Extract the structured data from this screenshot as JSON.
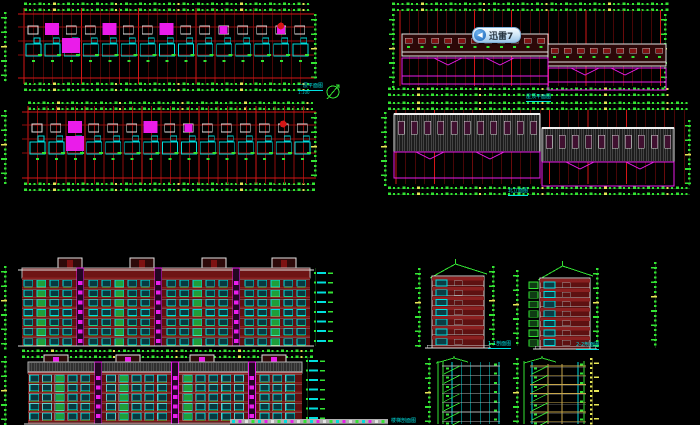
{
  "app": {
    "background": "#000000",
    "kind": "cad-architectural-sheet"
  },
  "watermark": {
    "label": "迅雷7",
    "icon": "xunlei-arrow-icon"
  },
  "labels": {
    "plan1_title": "一层平面图",
    "plan1_scale": "1:100",
    "roof_plan_title": "屋顶平面图",
    "rear_elev_title": "北立面图",
    "side_elev1_title": "1-1剖面图",
    "side_elev2_title": "2-2剖面图",
    "bottom_partial_title": "楼梯剖面图"
  },
  "palette": {
    "bg": "#000000",
    "red": "#8f0d0d",
    "red_bright": "#d41616",
    "green": "#33e433",
    "green_dim": "#1d6b1d",
    "yellow": "#e6e655",
    "cyan": "#00dede",
    "magenta": "#ea1cea",
    "white": "#e2e2e2",
    "gray": "#b2b2b2",
    "wall": "#5e1111",
    "slab": "#8a2020",
    "window_fill": "#073940",
    "window_green": "#1f9e3a",
    "hatch": "#8f8f8f",
    "band_fill": "#1c1c1c",
    "win_purple": "#401030",
    "tan": "#c8a84b",
    "badge_blue": "#2b7fd4"
  },
  "scene": {
    "plans": [
      {
        "gx": 24,
        "gy": 14,
        "gw": 286,
        "gh": 64,
        "bays": 15,
        "verts": 30,
        "step": 9.55,
        "seed": 3,
        "topDim": {
          "x": 24,
          "y": 2,
          "w": 286
        },
        "botDim": {
          "x": 24,
          "y": 82,
          "w": 286
        },
        "leftCol": {
          "x": 4,
          "y": 12,
          "h": 70
        },
        "rightCol": {
          "x": 314,
          "y": 14,
          "h": 64
        }
      },
      {
        "gx": 28,
        "gy": 112,
        "gw": 284,
        "gh": 66,
        "bays": 15,
        "verts": 30,
        "step": 9.5,
        "seed": 8,
        "topDim": {
          "x": 28,
          "y": 101,
          "w": 284
        },
        "botDim": {
          "x": 24,
          "y": 182,
          "w": 288
        },
        "leftCol": {
          "x": 4,
          "y": 110,
          "h": 72
        },
        "rightCol": {
          "x": 314,
          "y": 112,
          "h": 64
        }
      }
    ],
    "roofPlan": {
      "topDim": {
        "x": 392,
        "y": 2,
        "w": 274
      },
      "botDim": {
        "x": 388,
        "y": 87,
        "w": 280
      },
      "verts": 29,
      "vx": 400,
      "step": 9.3,
      "vy1": 10,
      "vy2": 86,
      "bands": [
        {
          "x": 402,
          "y": 34,
          "w": 146,
          "h": 22,
          "win": 11
        },
        {
          "x": 548,
          "y": 44,
          "w": 118,
          "h": 22,
          "win": 9
        }
      ],
      "mag": [
        {
          "x": 402,
          "y": 58,
          "w": 146,
          "h": 26,
          "chev": [
            448,
            500
          ]
        },
        {
          "x": 548,
          "y": 68,
          "w": 118,
          "h": 22,
          "chev": [
            585,
            625
          ]
        }
      ],
      "cols": [
        {
          "x": 392,
          "y": 14,
          "h": 72
        },
        {
          "x": 664,
          "y": 14,
          "h": 72
        }
      ]
    },
    "rearElev": {
      "topDim": {
        "x": 388,
        "y": 101,
        "w": 300
      },
      "botDim": {
        "x": 388,
        "y": 186,
        "w": 302
      },
      "verts": 31,
      "vx": 396,
      "step": 9.6,
      "vy1": 110,
      "vy2": 184,
      "bands": [
        {
          "x": 394,
          "y": 114,
          "w": 146,
          "h": 38,
          "win": 11
        },
        {
          "x": 542,
          "y": 128,
          "w": 132,
          "h": 34,
          "win": 10
        }
      ],
      "mag": [
        {
          "x": 394,
          "y": 152,
          "w": 146,
          "h": 26,
          "chev": [
            430,
            490
          ]
        },
        {
          "x": 542,
          "y": 162,
          "w": 132,
          "h": 24,
          "chev": [
            580,
            640
          ]
        }
      ],
      "cols": [
        {
          "x": 384,
          "y": 112,
          "h": 74
        },
        {
          "x": 688,
          "y": 120,
          "h": 66
        }
      ]
    },
    "frontElevs": [
      {
        "x": 22,
        "w": 288,
        "roofY": 268,
        "bodyTop": 278,
        "floors": 7,
        "floorH": 9.7,
        "bays": 22,
        "bayW": 13,
        "bx0": 24,
        "ground": 346,
        "stairs": [
          4,
          10,
          16
        ],
        "bulk": [
          58,
          130,
          202,
          272
        ],
        "bulkY": 258,
        "variant": "A",
        "leftCol": {
          "x": 4,
          "y": 266,
          "h": 82
        },
        "rightCol": {
          "x": 314,
          "y": 268,
          "h": 78
        }
      },
      {
        "x": 28,
        "w": 274,
        "roofY": 362,
        "bodyTop": 373,
        "floors": 6,
        "floorH": 9.5,
        "bays": 21,
        "bayW": 12.8,
        "bx0": 30,
        "ground": 424,
        "stairs": [
          5,
          11,
          17
        ],
        "bulk": [
          44,
          116,
          190,
          262
        ],
        "bulkY": 355,
        "variant": "B",
        "leftCol": {
          "x": 4,
          "y": 356,
          "h": 68
        },
        "rightCol": {
          "x": 306,
          "y": 356,
          "h": 68
        }
      }
    ],
    "sideElevs": [
      {
        "x": 432,
        "w": 52,
        "top": 264,
        "bodyTop": 276,
        "floors": 7,
        "floorH": 9.8,
        "ground": 348,
        "balc": false,
        "cols": [
          {
            "x": 418,
            "y": 268,
            "h": 78
          },
          {
            "x": 492,
            "y": 266,
            "h": 80
          }
        ]
      },
      {
        "x": 540,
        "w": 50,
        "top": 266,
        "bodyTop": 278,
        "floors": 7,
        "floorH": 9.6,
        "ground": 349,
        "balc": true,
        "cols": [
          {
            "x": 516,
            "y": 270,
            "h": 76
          },
          {
            "x": 596,
            "y": 268,
            "h": 78
          }
        ]
      }
    ],
    "farCol": {
      "x": 654,
      "y": 262,
      "h": 86
    },
    "stairs": [
      {
        "x": 436,
        "y": 358,
        "w": 64,
        "h": 66,
        "tone": "green"
      },
      {
        "x": 524,
        "y": 358,
        "w": 62,
        "h": 66,
        "tone": "tan",
        "yellowCol": {
          "x": 590,
          "y": 358,
          "h": 66
        }
      }
    ],
    "northArrow": {
      "cx": 333,
      "cy": 92,
      "r": 6
    },
    "groundStrip": {
      "x": 230,
      "y": 419,
      "w": 158,
      "h": 5
    }
  }
}
